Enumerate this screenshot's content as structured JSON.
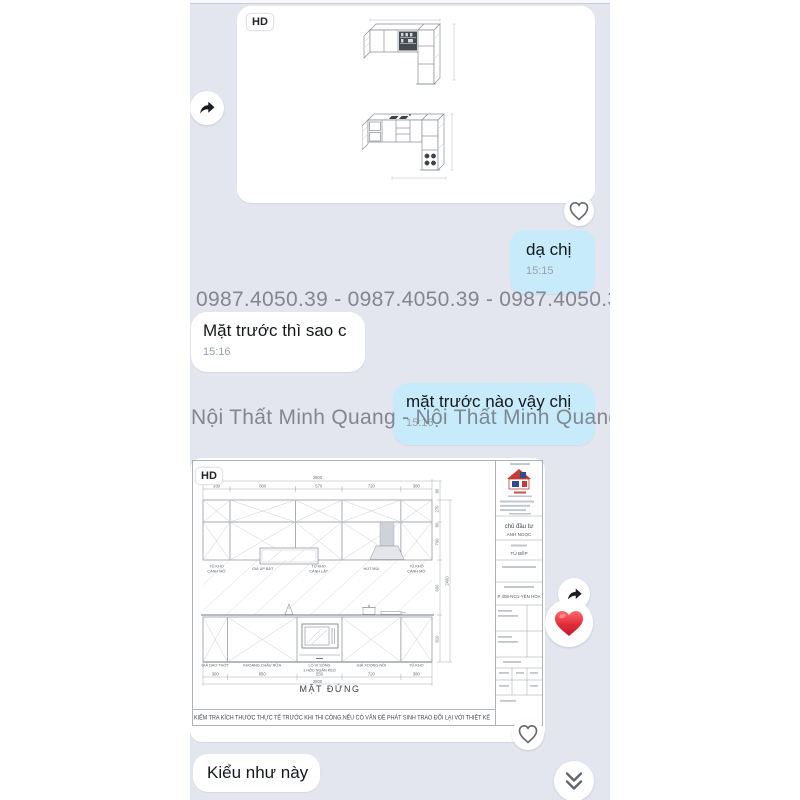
{
  "messages": {
    "image1": {
      "hd_badge": "HD",
      "description": "isometric L-shaped kitchen cabinet renders"
    },
    "reply1": {
      "text": "dạ chị",
      "time": "15:15"
    },
    "incoming1": {
      "text": "Mặt trước thì sao c",
      "time": "15:16"
    },
    "outgoing1": {
      "text": "mặt trước nào vậy chị",
      "time": "15:16"
    },
    "image2": {
      "hd_badge": "HD",
      "description": "kitchen front elevation technical drawing"
    },
    "incoming2": {
      "text": "Kiểu như này"
    }
  },
  "watermarks": {
    "phone_row": "0987.4050.39 - 0987.4050.39 - 0987.4050.39 - 0",
    "brand_row": "Nội Thất Minh Quang - Nội Thất Minh Quang - N"
  },
  "reactions": {
    "heart_emoji": "❤️"
  },
  "icons": {
    "forward": "forward-share-arrow",
    "heart_outline": "heart-outline",
    "chevron": "double-chevron-down"
  },
  "drawing": {
    "title": "MẶT ĐỨNG",
    "top_total": "2800",
    "top_dims": [
      "330",
      "800",
      "570",
      "720",
      "380"
    ],
    "bottom_dims": [
      "300",
      "850",
      "550",
      "720",
      "380"
    ],
    "bottom_total": "2800",
    "side_dims": [
      "80",
      "270",
      "80",
      "700",
      "600",
      "810"
    ],
    "side_total": "2400",
    "wall_labels": [
      {
        "l1": "TỦ KHO",
        "l2": "CÁNH MỞ"
      },
      {
        "l1": "GIÁ ÚP BÁT",
        "l2": ""
      },
      {
        "l1": "TỦ KHO",
        "l2": "CÁNH LẬT"
      },
      {
        "l1": "HÚT MÙI",
        "l2": ""
      },
      {
        "l1": "TỦ KHÔ",
        "l2": "CÁNH MỞ"
      }
    ],
    "base_labels": [
      "GIÁ DAO THỚT",
      "KHOANG CHẬU RỬA",
      "LÒ VI SÓNG",
      "GIÁ XOONG NỒI",
      "TỦ KHO"
    ],
    "base_sublabel": "1 HỘC NGĂN KÉO",
    "disclaimer": "KIỂM TRA KÍCH THƯỚC THỰC TẾ TRƯỚC KHI THI CÔNG.NẾU CÓ VẤN ĐỀ PHÁT SINH TRAO ĐỔI LẠI VỚI THIẾT KẾ",
    "title_block": {
      "investor_label": "chủ đầu tư",
      "investor": "ANH NGỌC",
      "item": "TỦ BẾP",
      "address": "P 408-NO1-YÊN HÒA"
    }
  },
  "colors": {
    "chat_bg": "#e3e5ef",
    "bubble_blue": "#c8ebfb",
    "bubble_white": "#ffffff",
    "watermark_gray": "#686c77",
    "heart_red": "#e02b39",
    "logo_red": "#c43a35",
    "logo_blue": "#2e4d8f"
  }
}
